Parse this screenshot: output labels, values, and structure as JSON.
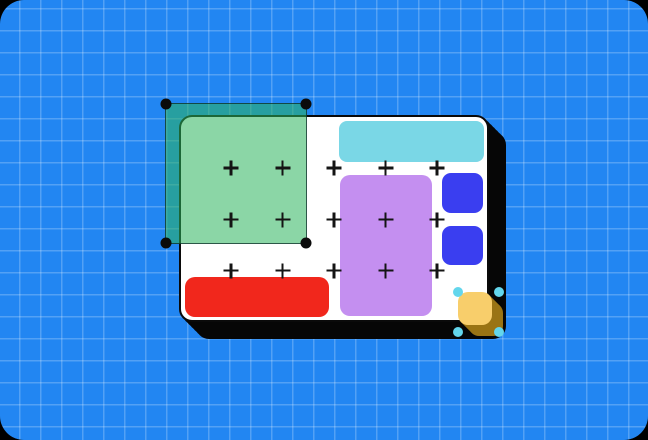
{
  "canvas": {
    "background_color": "#2286F2",
    "grid_line_color": "rgba(255,255,255,0.22)",
    "outer_corner_color": "#000000",
    "grid_cell_px": {
      "w": 21,
      "h": 22
    }
  },
  "frame": {
    "fill": "#FFFFFF",
    "border_color": "#0A0A0A",
    "shadow_color": "#060606"
  },
  "shapes": {
    "cyan_banner_color": "#7AD7E6",
    "purple_panel_color": "#C48FF0",
    "indigo_square_color": "#3A3EF0",
    "red_bar_color": "#F1271C",
    "yellow_square_color": "#F8CE6B",
    "yellow_square_shadow_color": "#9A7414"
  },
  "green_selection": {
    "fill": "rgba(44,180,93,0.55)",
    "border_color": "rgba(12,44,40,0.75)",
    "handle_color": "#0B0B0B",
    "handle_shape": "circle",
    "handle_count": 4
  },
  "cyan_selection": {
    "handle_color": "#63D6EC",
    "handle_shape": "circle",
    "handle_count": 4
  },
  "plus_grid": {
    "color": "#141414",
    "xs": [
      231,
      282.5,
      334,
      385.5,
      437
    ],
    "ys": [
      168,
      219.5,
      270.5
    ],
    "count": 15
  }
}
